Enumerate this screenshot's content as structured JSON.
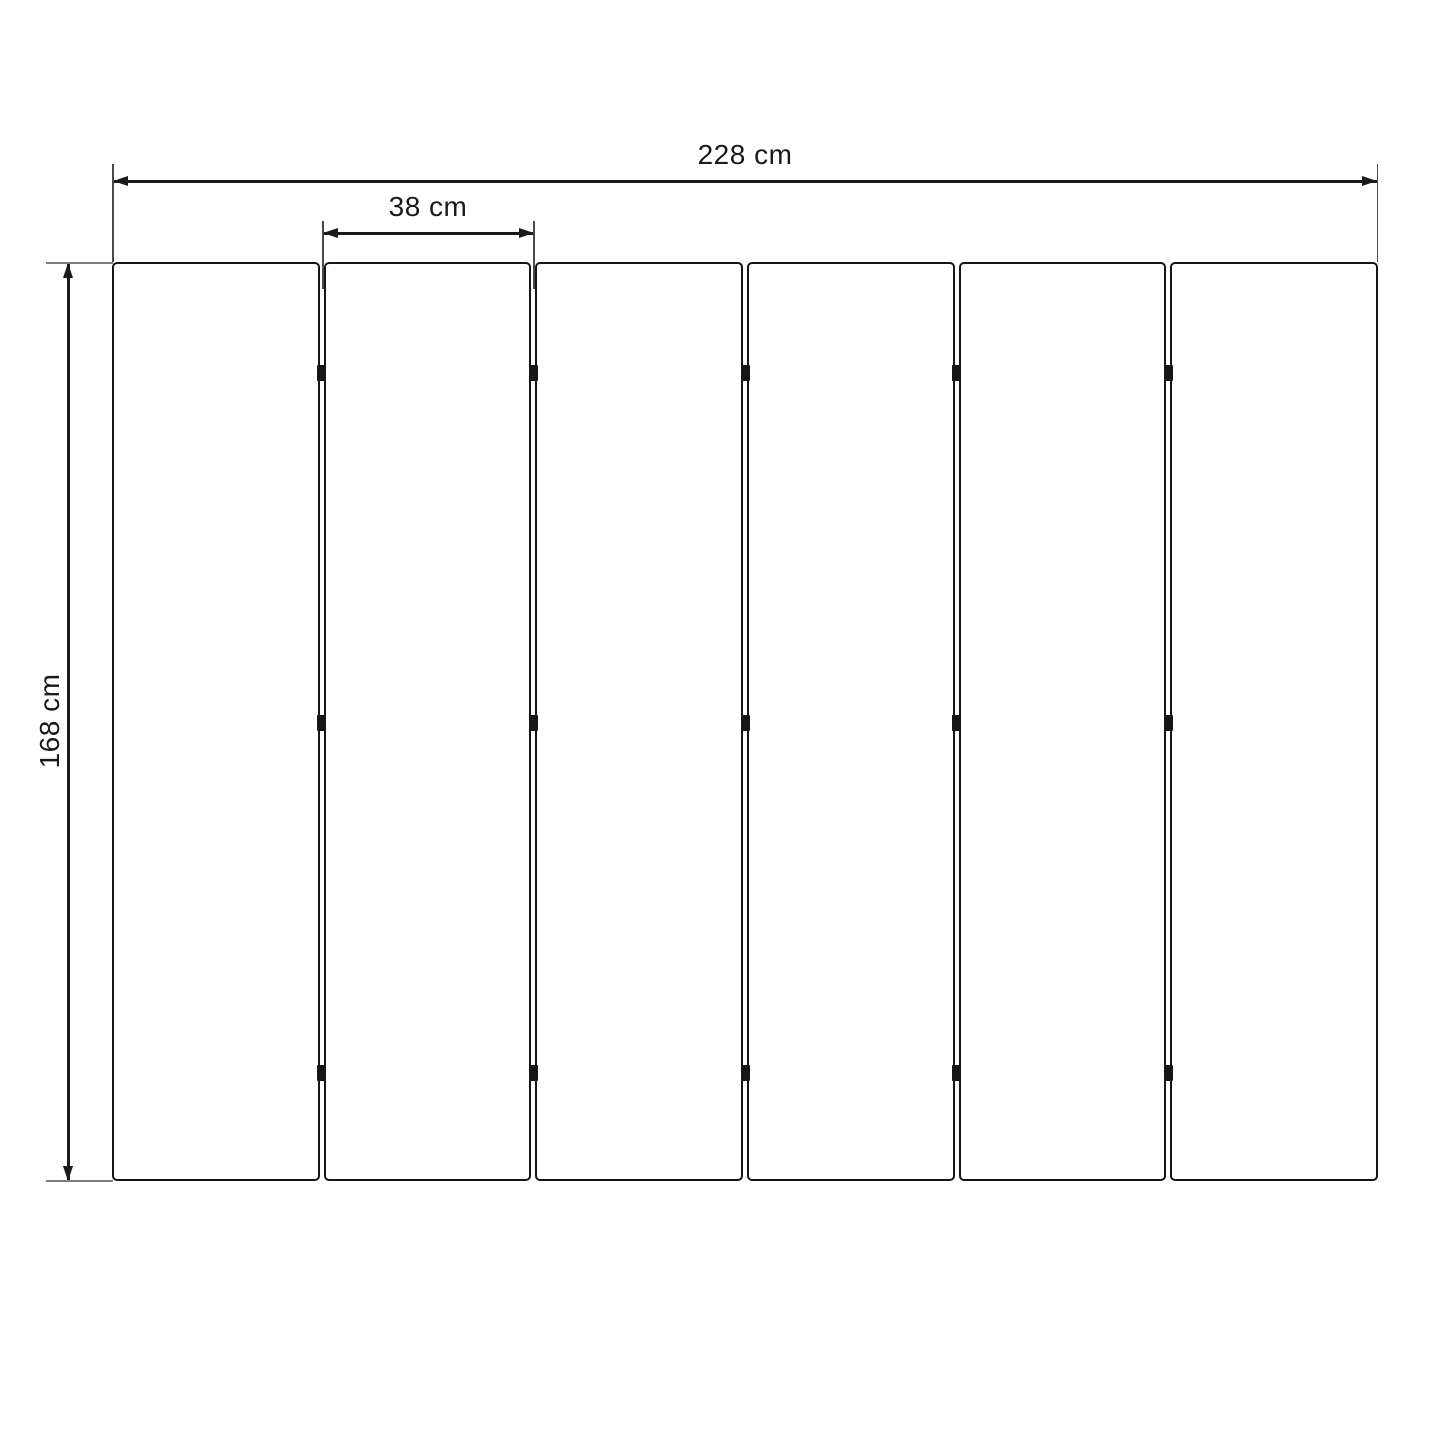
{
  "diagram": {
    "type": "folding-screen-dimension-drawing",
    "panels": {
      "count": 6,
      "gaps": 5,
      "hinges_per_gap": 3
    },
    "dimensions": {
      "total_width": {
        "label": "228 cm",
        "value_cm": 228
      },
      "panel_width": {
        "label": "38 cm",
        "value_cm": 38
      },
      "height": {
        "label": "168 cm",
        "value_cm": 168
      }
    },
    "colors": {
      "background": "#ffffff",
      "ink": "#1a1a1a",
      "panel_border": "#161616",
      "panel_fill": "#ffffff",
      "hinge": "#161616",
      "extension_line_gray": "#7d7d7d",
      "extension_line_dark": "#4a4a4a"
    }
  }
}
